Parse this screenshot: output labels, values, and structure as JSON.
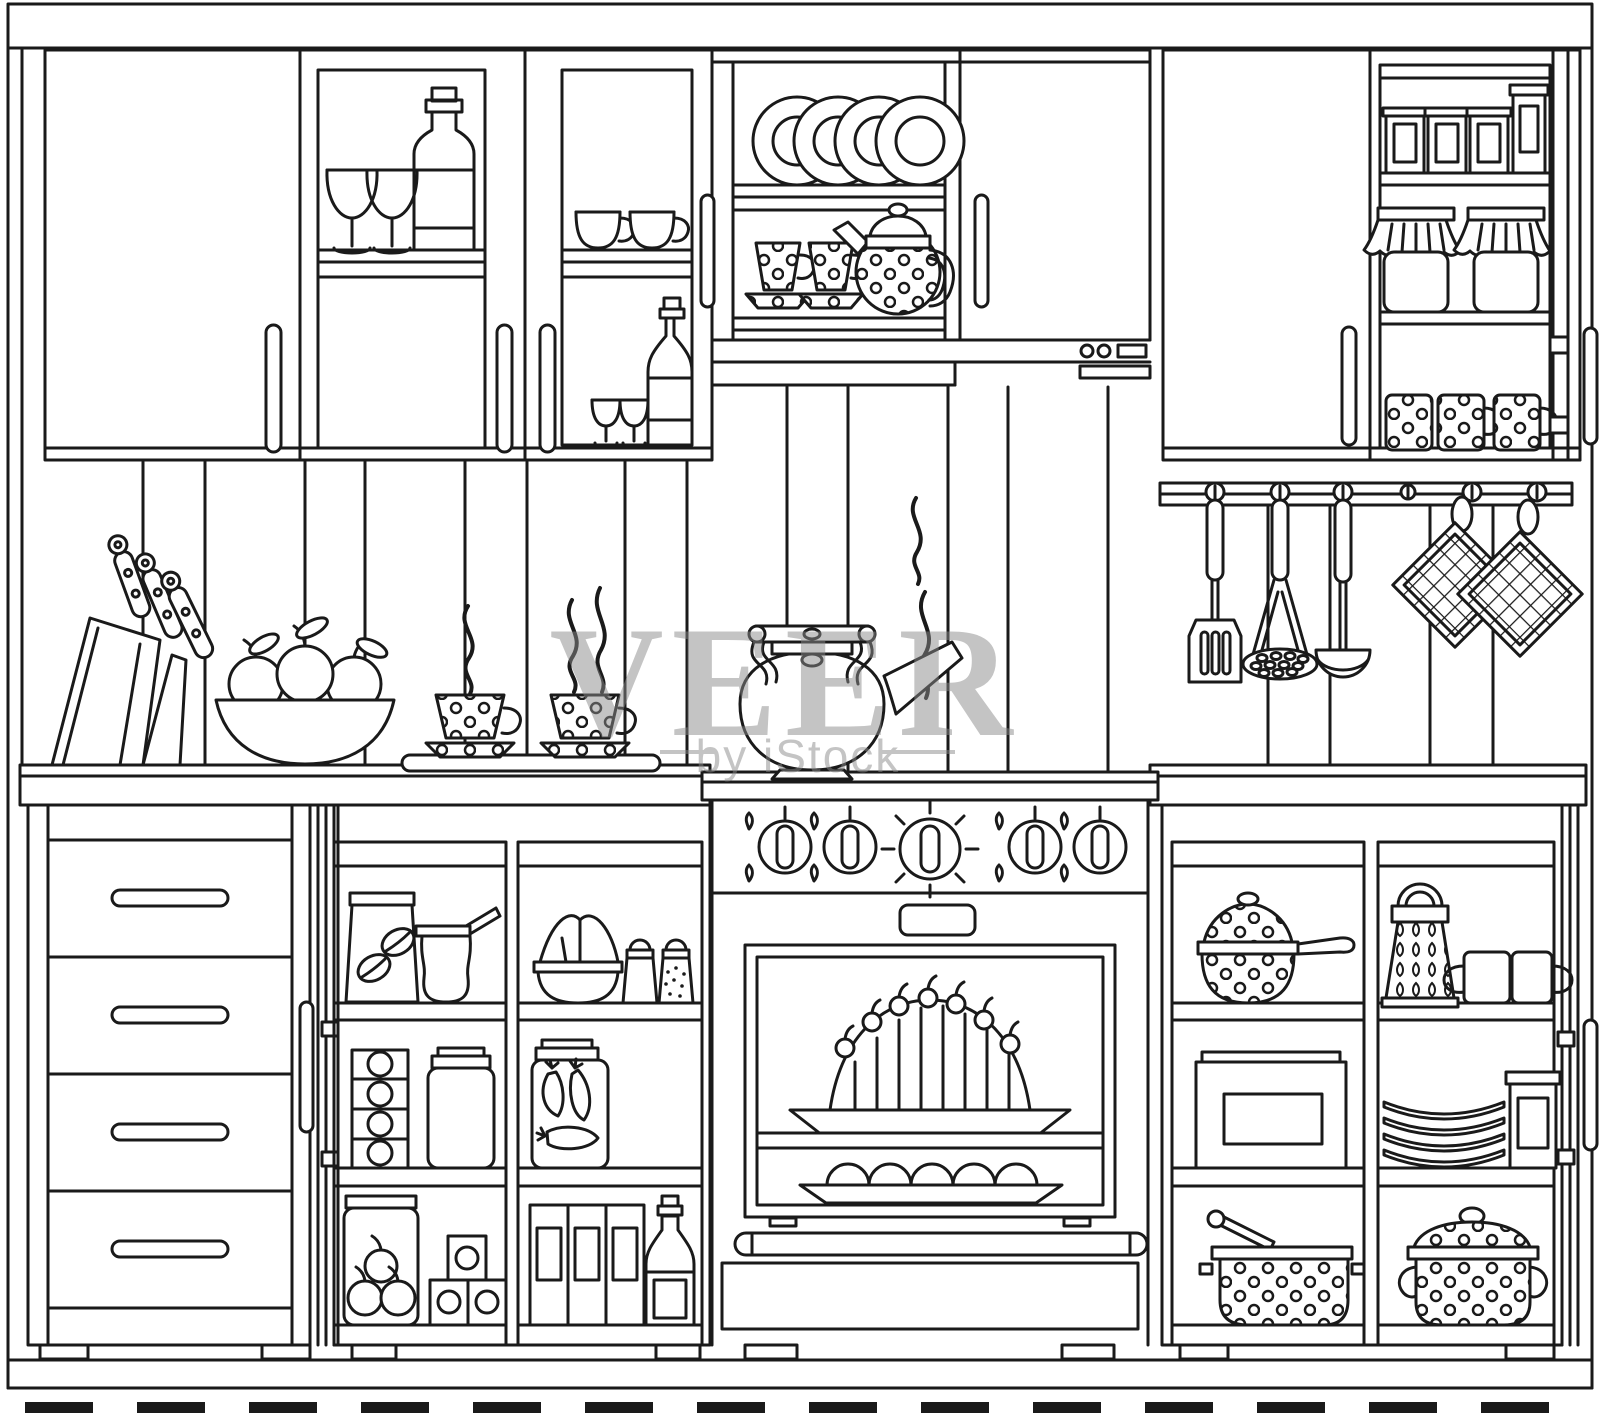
{
  "watermark": {
    "title": "VEER",
    "subtitle": "by iStock"
  },
  "colors": {
    "line": "#1a1a1a",
    "background": "#ffffff",
    "watermark": "#8a8a8a"
  },
  "scene": {
    "type": "line-art illustration",
    "subject": "kitchen interior front elevation",
    "objects": [
      "wall-cabinet-plain-door",
      "wall-cabinet-glass-wine-bottle-and-glasses",
      "wall-cabinet-glass-cups-and-bottle",
      "open-shelf-plates",
      "polka-dot-teacups",
      "polka-dot-teapot",
      "closed-cabinet-door",
      "shelf-tins",
      "jam-jars-with-cloth-covers",
      "polka-dot-mugs",
      "open-cabinet-door",
      "utensil-rail",
      "spatula",
      "potato-masher",
      "ladle",
      "checkered-pot-holders",
      "knife-block-with-knives",
      "fruit-bowl-with-apples",
      "steaming-coffee-cups-on-tray",
      "steaming-kettle",
      "stove-with-five-knobs",
      "oven-with-cherry-cake",
      "tray-of-buns",
      "oven-handle",
      "drawer-unit-four-drawers",
      "coffee-bag",
      "cezve",
      "flour-bowl",
      "salt-and-pepper-shakers",
      "spice-box-stack",
      "storage-jar",
      "pickled-eggplant-jar",
      "apple-jar",
      "canned-boxes",
      "cereal-boxes",
      "wine-bottle",
      "polka-dot-saucepan",
      "grater",
      "mugs",
      "bread-box",
      "plate-stack",
      "canister",
      "pot-with-spoon",
      "polka-dot-stockpot",
      "baseboard",
      "floor-tiles"
    ]
  }
}
